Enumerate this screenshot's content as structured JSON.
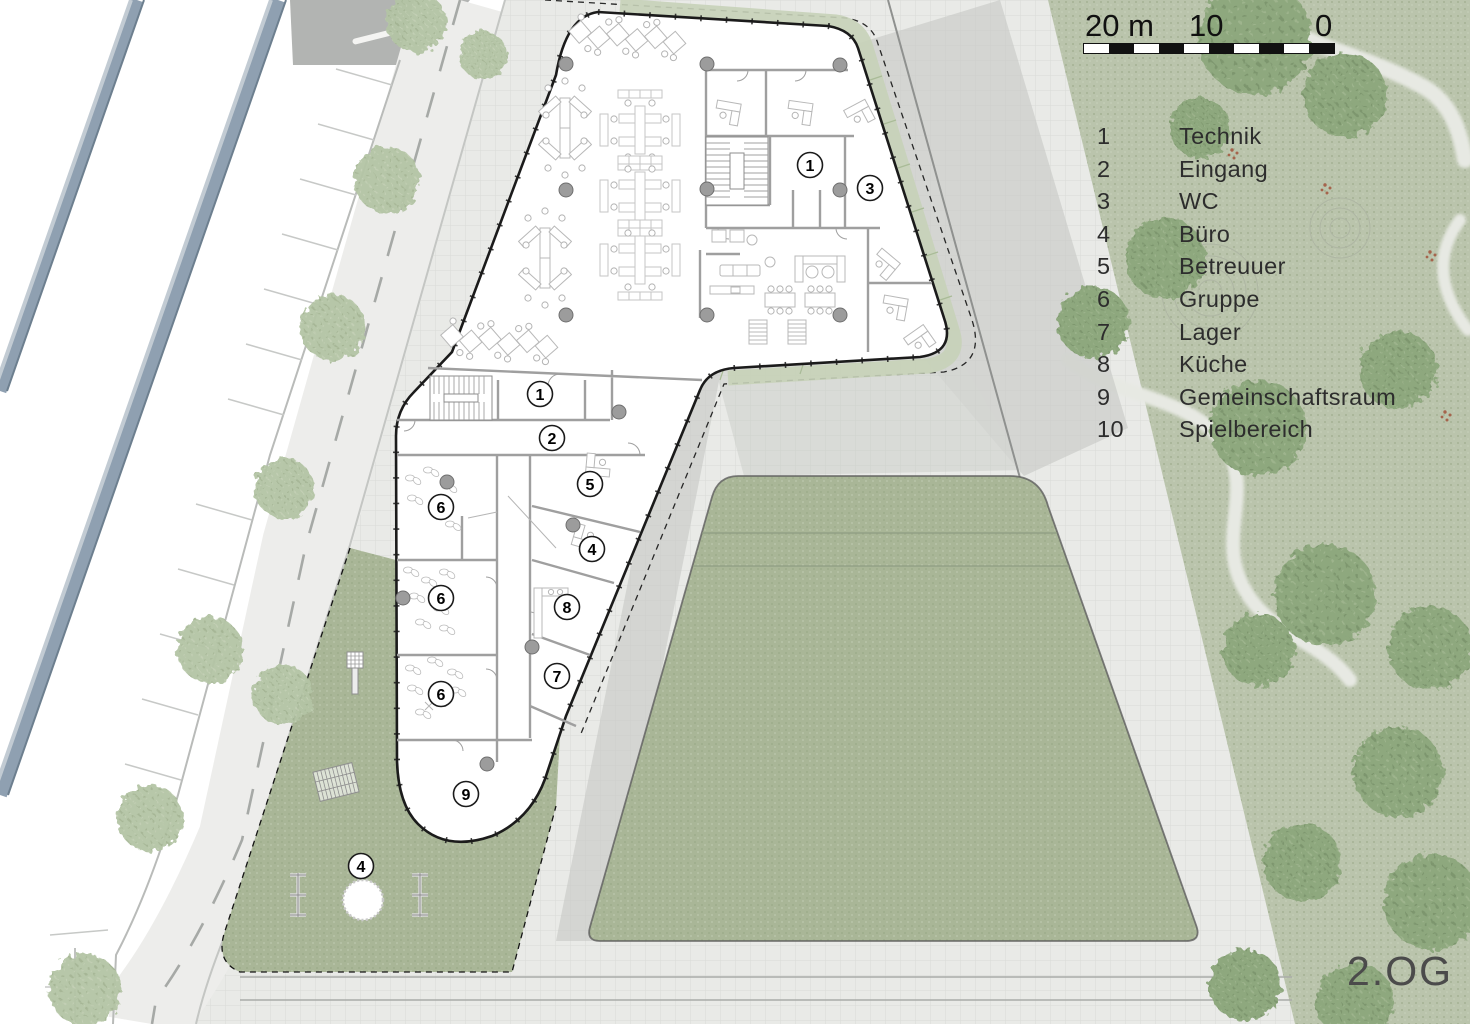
{
  "scale_bar": {
    "label_20": "20 m",
    "label_10": "10",
    "label_0": "0",
    "segments": 10
  },
  "legend": {
    "items": [
      {
        "number": "1",
        "label": "Technik"
      },
      {
        "number": "2",
        "label": "Eingang"
      },
      {
        "number": "3",
        "label": "WC"
      },
      {
        "number": "4",
        "label": "Büro"
      },
      {
        "number": "5",
        "label": "Betreuuer"
      },
      {
        "number": "6",
        "label": "Gruppe"
      },
      {
        "number": "7",
        "label": "Lager"
      },
      {
        "number": "8",
        "label": "Küche"
      },
      {
        "number": "9",
        "label": "Gemeinschaftsraum"
      },
      {
        "number": "10",
        "label": "Spielbereich"
      }
    ]
  },
  "floor_label": "2.OG",
  "plan": {
    "room_badges": [
      {
        "number": "1",
        "x": 810,
        "y": 165
      },
      {
        "number": "3",
        "x": 870,
        "y": 188
      },
      {
        "number": "1",
        "x": 540,
        "y": 394
      },
      {
        "number": "2",
        "x": 552,
        "y": 438
      },
      {
        "number": "5",
        "x": 590,
        "y": 484
      },
      {
        "number": "4",
        "x": 592,
        "y": 549
      },
      {
        "number": "6",
        "x": 441,
        "y": 507
      },
      {
        "number": "6",
        "x": 441,
        "y": 598
      },
      {
        "number": "6",
        "x": 441,
        "y": 694
      },
      {
        "number": "8",
        "x": 567,
        "y": 607
      },
      {
        "number": "7",
        "x": 557,
        "y": 676
      },
      {
        "number": "9",
        "x": 466,
        "y": 794
      },
      {
        "number": "4",
        "x": 361,
        "y": 866
      }
    ]
  },
  "palette": {
    "park": "#bac4ac",
    "grass": "#a9b697",
    "paving": "#e9eae7",
    "shadow": "#c7c9c6",
    "road_dark": "#b2b4b2",
    "rail_blue": "#8fa0b1",
    "wall": "#1b1b1b",
    "text": "#2d2d2d"
  }
}
